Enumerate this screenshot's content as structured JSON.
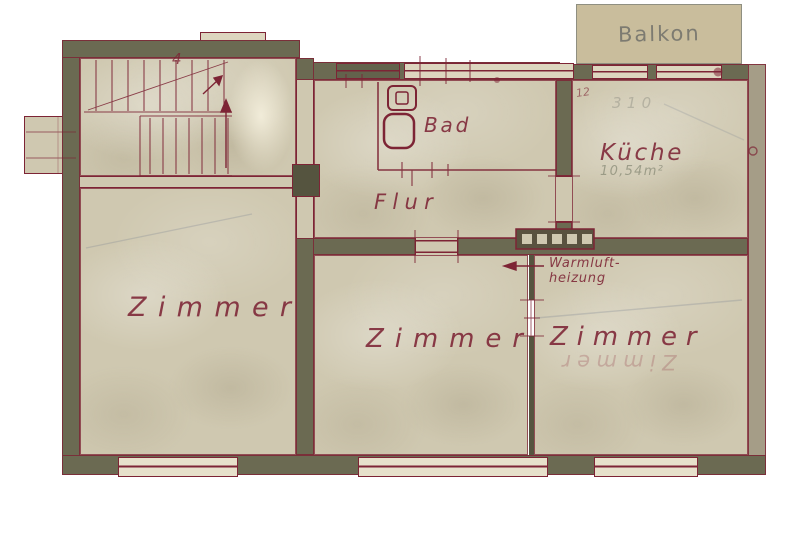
{
  "labels": {
    "balcony": "Balkon",
    "room_left": "Zimmer",
    "room_middle": "Zimmer",
    "room_right": "Zimmer",
    "kitchen": "Küche",
    "bath": "Bad",
    "hall": "Flur",
    "heating_line1": "Warmluft-",
    "heating_line2": "heizung",
    "kitchen_area_faint": "10,54m²",
    "kitchen_pencil_faint": "310",
    "kitchen_dim_mark": "12",
    "stair_mark": "4",
    "ghost_room": "Zimmer"
  },
  "colors": {
    "background": "#ffffff",
    "paper": "#cfc8b0",
    "paper_light": "#ddd6bf",
    "wall": "#6b6a52",
    "wall_right": "#a59d87",
    "ink": "#7d2435",
    "balcony_fill": "#c9bd9c",
    "balcony_border": "#8f8f81",
    "balcony_text": "#70706a",
    "pencil": "#7f8894"
  }
}
